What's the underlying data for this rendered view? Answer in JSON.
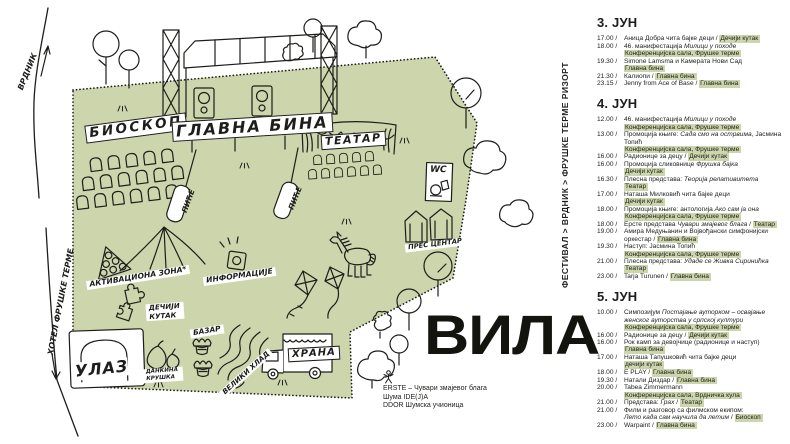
{
  "logo": "ВИЛА",
  "side_banner": "ФЕСТИВАЛ > ВРДНИК > ФРУШКЕ ТЕРМЕ РИЗОРТ",
  "colors": {
    "map_green": "#ccd5ab",
    "ink": "#1d1d1b",
    "highlight": "#ccd5ab"
  },
  "map": {
    "roads": {
      "vrdnik": "ВРДНИК",
      "hotel": "ХОТЕЛ ФРУШКЕ ТЕРМЕ"
    },
    "labels": {
      "bioskop": "БИОСКОП",
      "glavna_bina": "ГЛАВНА БИНА",
      "teatar": "ТЕАТАР",
      "pice": "ПИЋЕ",
      "wc": "WC",
      "pres_centar": "ПРЕС ЦЕНТАР",
      "aktivaciona_zona": "АКТИВАЦИОНА ЗОНА*",
      "informacije": "ИНФОРМАЦИЈЕ",
      "deciji_kutak": "ДЕЧИЈИ КУТАК",
      "bazar": "БАЗАР",
      "ulaz": "УЛАЗ",
      "dankina_kruska": "ДАНКИНА КРУШКА",
      "veliki_hlad": "ВЕЛИКИ ХЛАД",
      "hrana": "ХРАНА"
    }
  },
  "legend": {
    "lines": [
      "ERSTE – Чувари змајевог блага",
      "Шума IDE(Ј)А",
      "DDOR Шумска учионица"
    ]
  },
  "schedule": {
    "days": [
      {
        "title": "3. ЈУН",
        "events": [
          {
            "time": "17.00",
            "pre": "Аница Добра чита бајке деци",
            "venue": "Дечији кутак",
            "inline": true
          },
          {
            "time": "18.00",
            "pre": "46. манифестација ",
            "italic": "Милици у походе",
            "venue": "Конференцијска сала, Фрушке терме",
            "inline": false
          },
          {
            "time": "19.30",
            "pre": "Simone Lamsma и Камерата Нови Сад",
            "venue": "Главна бина",
            "inline": false
          },
          {
            "time": "21.30",
            "pre": "Калиопи",
            "venue": "Главна бина",
            "inline": true
          },
          {
            "time": "23.15",
            "pre": "Jenny from Ace of Base",
            "venue": "Главна бина",
            "inline": true
          }
        ]
      },
      {
        "title": "4. ЈУН",
        "events": [
          {
            "time": "12.00",
            "pre": "46. манифестација ",
            "italic": "Милици у походе",
            "venue": "Конференцијска сала, Фрушке терме",
            "inline": false
          },
          {
            "time": "13.00",
            "pre": "Промоција књиге: ",
            "italic": "Сада смо на острвима",
            "post": ", Јасмина Топић",
            "venue": "Конференцијска сала, Фрушке терме",
            "inline": false
          },
          {
            "time": "16.00",
            "pre": "Радионице за децу",
            "venue": "Дечији кутак",
            "inline": true
          },
          {
            "time": "16.00",
            "pre": "Промоција сликовнице ",
            "italic": "Фрушка бајка",
            "venue": "Дечији кутак",
            "inline": false
          },
          {
            "time": "16.30",
            "pre": "Плесна представа: ",
            "italic": "Теорија релативитета",
            "venue": "Театар",
            "inline": false
          },
          {
            "time": "17.00",
            "pre": "Наташа Милковић чита бајке деци",
            "venue": "Дечији кутак",
            "inline": false
          },
          {
            "time": "18.00",
            "pre": "Промоција књиге: антологија ",
            "italic": "Ако сам ја она",
            "venue": "Конференцијска сала, Фрушке терме",
            "inline": false
          },
          {
            "time": "18.00",
            "pre": "Ерсте представа ",
            "italic": "Чувари змајевог блага",
            "venue": "Театар",
            "inline": true
          },
          {
            "time": "19.00",
            "pre": "Амира Медуњанин и Војвођански симфонијски оркестар",
            "venue": "Главна бина",
            "inline": true
          },
          {
            "time": "19.30",
            "pre": "Наступ: Јасмина Топић",
            "venue": "Конференцијска сала, Фрушке терме",
            "inline": false
          },
          {
            "time": "21.00",
            "pre": "Плесна представа: ",
            "italic": "Удаде се Живка Сиринићка",
            "venue": "Театар",
            "inline": false
          },
          {
            "time": "23.00",
            "pre": "Tarja Turunen",
            "venue": "Главна бина",
            "inline": true
          }
        ]
      },
      {
        "title": "5. ЈУН",
        "events": [
          {
            "time": "10.00",
            "pre": "Симпозијум ",
            "italic": "Постајање ауторком – освајање женског ауторства у српској култури",
            "venue": "Конференцијска сала, Фрушке терме",
            "inline": false
          },
          {
            "time": "16.00",
            "pre": "Радионице за децу",
            "venue": "Дечији кутак",
            "inline": true
          },
          {
            "time": "16.00",
            "pre": "Рок камп за девојчице (радионице и наступ)",
            "venue": "Главна бина",
            "inline": false
          },
          {
            "time": "17.00",
            "pre": "Наташа Тапушковић чита бајке деци",
            "venue": "дечији кутак",
            "inline": false
          },
          {
            "time": "18.00",
            "pre": "E PLAY",
            "venue": "Главна бина",
            "inline": true
          },
          {
            "time": "19.30",
            "pre": "Натали Диздар",
            "venue": "Главна бина",
            "inline": true
          },
          {
            "time": "20.00",
            "pre": "Tabea Zimmermann",
            "venue": "Конференцијска сала, Врдничка кула",
            "inline": false
          },
          {
            "time": "21.00",
            "pre": "Представа: ",
            "italic": "Грах",
            "venue": "Театар",
            "inline": true
          },
          {
            "time": "21.00",
            "pre": "Филм и разговор са филмском екипом:",
            "br": true,
            "italic": "Лето када сам научила да летим",
            "venue": "Биоскоп",
            "inline": true
          },
          {
            "time": "23.00",
            "pre": "Warpaint",
            "venue": "Главна бина",
            "inline": true
          }
        ]
      }
    ]
  }
}
